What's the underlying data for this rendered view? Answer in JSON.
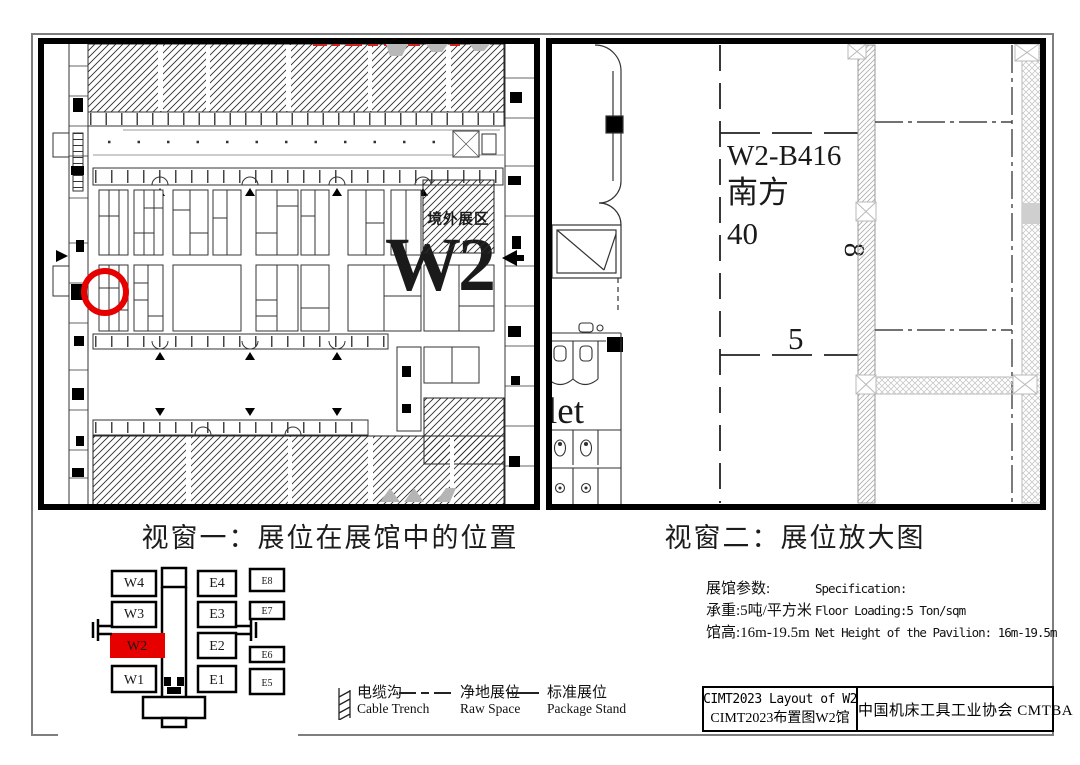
{
  "colors": {
    "accent_red": "#e60000",
    "watermark_gray": "#a9a9a9"
  },
  "captions": {
    "window1": "视窗一：展位在展馆中的位置",
    "window2": "视窗二：展位放大图"
  },
  "panel1": {
    "hall_watermark": "W2",
    "overseas_area_label": "境外展区"
  },
  "panel2": {
    "booth_id": "W2-B416",
    "exhibitor_name": "南方",
    "booth_area": "40",
    "dim_width": "8",
    "dim_depth": "5",
    "toilet_label_partial": "let"
  },
  "minimap": {
    "west_halls": [
      "W4",
      "W3",
      "W2",
      "W1"
    ],
    "east_halls": [
      "E4",
      "E3",
      "E2",
      "E1"
    ],
    "east_right_halls": [
      "E8",
      "E7",
      "E6",
      "E5"
    ],
    "highlighted_hall": "W2"
  },
  "legend": {
    "items": [
      {
        "zh": "电缆沟",
        "en": "Cable Trench"
      },
      {
        "zh": "净地展位",
        "en": "Raw Space"
      },
      {
        "zh": "标准展位",
        "en": "Package Stand"
      }
    ]
  },
  "specs": {
    "zh_header": "展馆参数:",
    "en_header": "Specification:",
    "rows": [
      {
        "zh": "承重:5吨/平方米",
        "en": "Floor Loading:5 Ton/sqm"
      },
      {
        "zh": "馆高:16m-19.5m",
        "en": "Net Height of the Pavilion: 16m-19.5m"
      }
    ]
  },
  "title_block": {
    "title_en": "CIMT2023 Layout of W2",
    "title_zh": "CIMT2023布置图W2馆",
    "organization": "中国机床工具工业协会 CMTBA"
  }
}
